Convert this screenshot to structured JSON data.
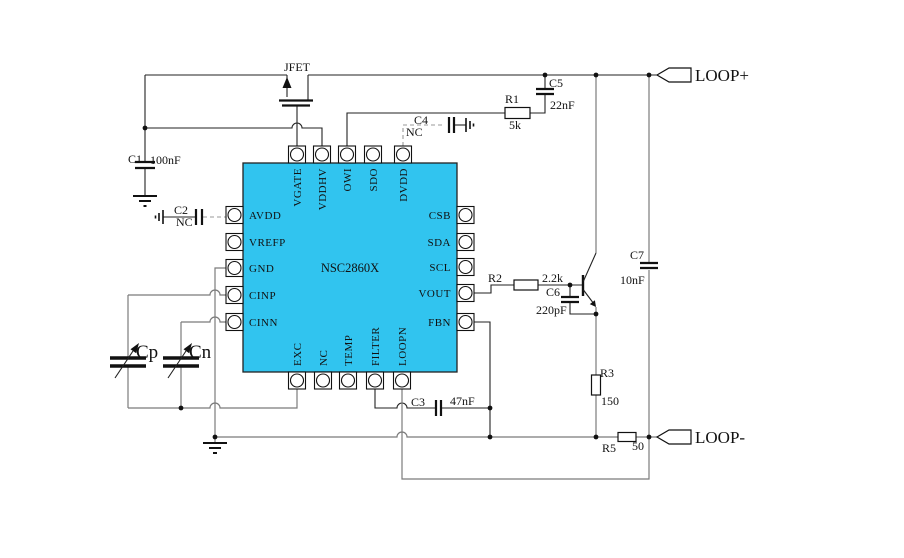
{
  "colors": {
    "background": "#ffffff",
    "ic_fill": "#31c4ef",
    "wire_dark": "#222222",
    "wire_gray": "#7b7b7b",
    "text": "#111111"
  },
  "ic": {
    "part_number": "NSC2860X",
    "pins_top": [
      "VGATE",
      "VDDHV",
      "OWI",
      "SDO",
      "DVDD"
    ],
    "pins_left": [
      "AVDD",
      "VREFP",
      "GND",
      "CINP",
      "CINN"
    ],
    "pins_right": [
      "CSB",
      "SDA",
      "SCL",
      "VOUT",
      "FBN"
    ],
    "pins_bottom": [
      "EXC",
      "NC",
      "TEMP",
      "FILTER",
      "LOOPN"
    ]
  },
  "components": {
    "jfet": {
      "label": "JFET"
    },
    "c1": {
      "ref": "C1",
      "value": "100nF"
    },
    "c2": {
      "ref": "C2",
      "value": "NC"
    },
    "c3": {
      "ref": "C3",
      "value": "47nF"
    },
    "c4": {
      "ref": "C4",
      "value": "NC"
    },
    "c5": {
      "ref": "C5",
      "value": "22nF"
    },
    "c6": {
      "ref": "C6",
      "value": "220pF"
    },
    "c7": {
      "ref": "C7",
      "value": "10nF"
    },
    "r1": {
      "ref": "R1",
      "value": "5k"
    },
    "r2": {
      "ref": "R2",
      "value": "2.2k"
    },
    "r3": {
      "ref": "R3",
      "value": "150"
    },
    "r5": {
      "ref": "R5",
      "value": "50"
    },
    "cp": {
      "ref": "Cp"
    },
    "cn": {
      "ref": "Cn"
    }
  },
  "connectors": {
    "loop_plus": "LOOP+",
    "loop_minus": "LOOP-"
  }
}
